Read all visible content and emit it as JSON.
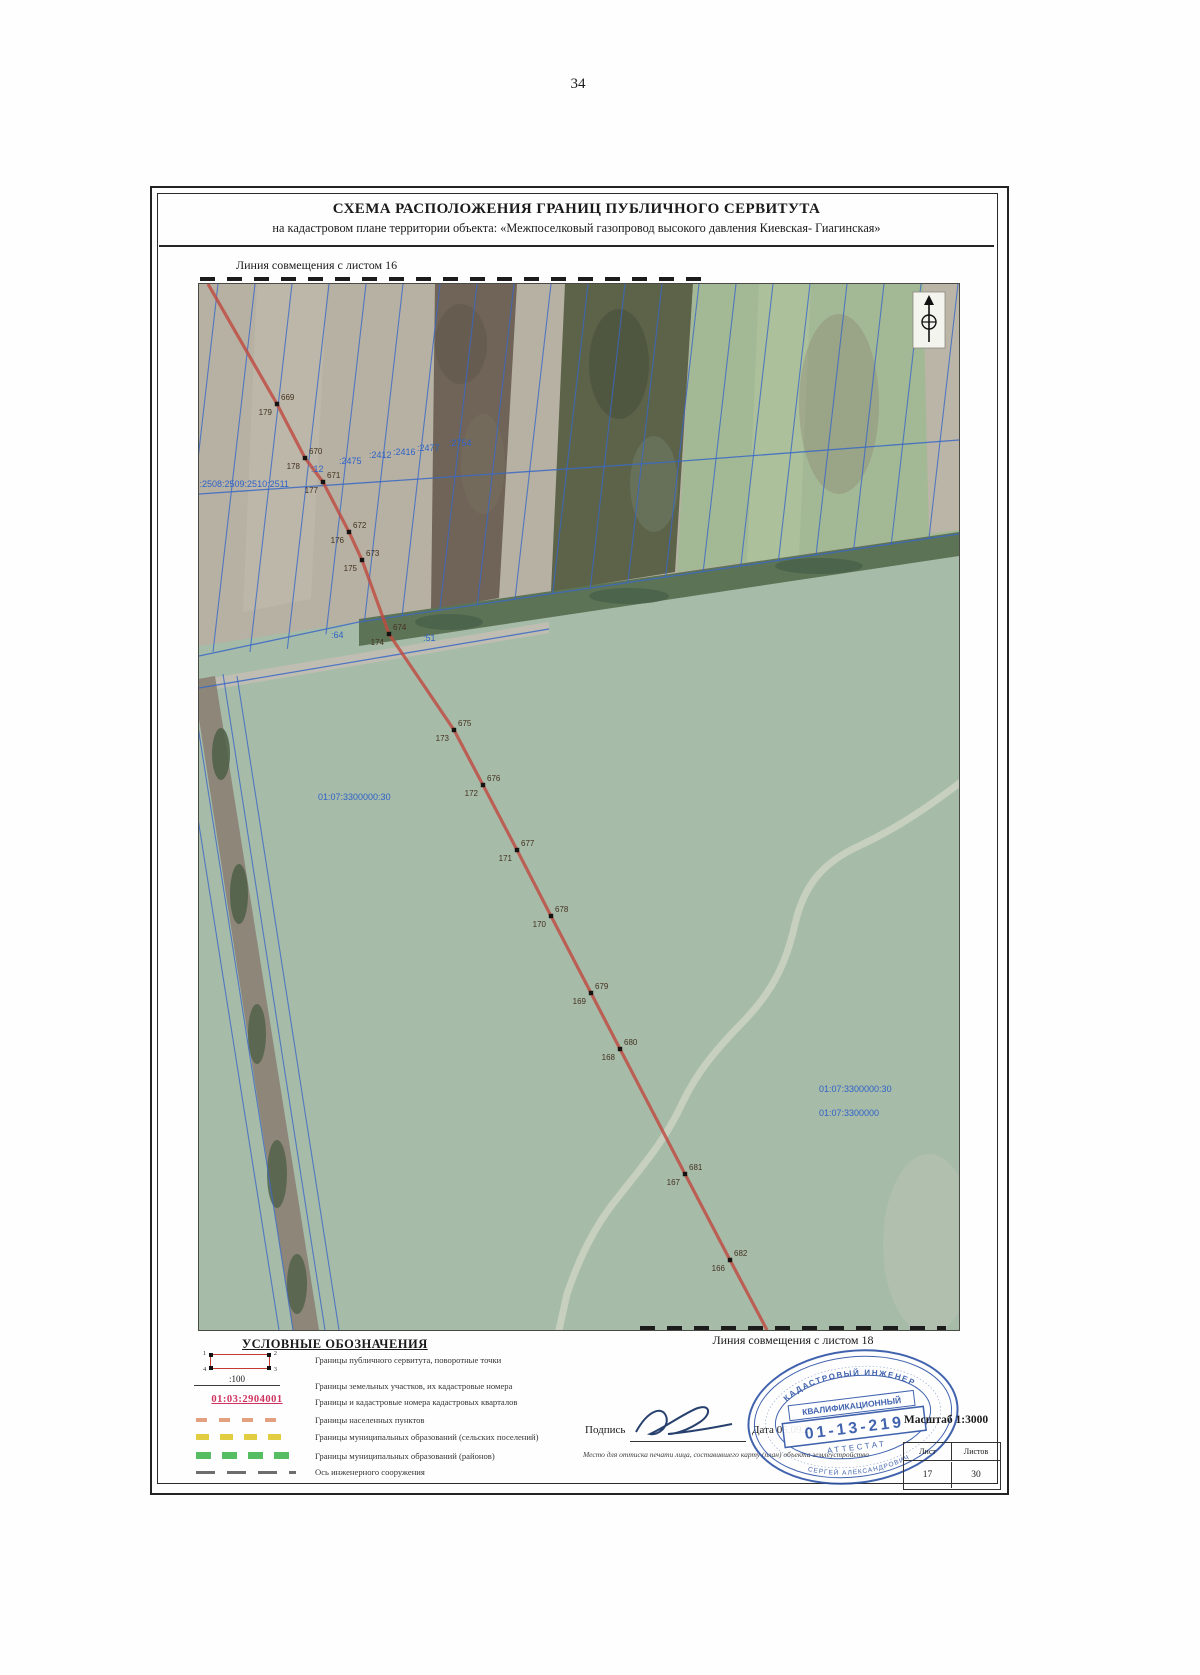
{
  "page": {
    "number": "34"
  },
  "header": {
    "title": "СХЕМА РАСПОЛОЖЕНИЯ ГРАНИЦ ПУБЛИЧНОГО СЕРВИТУТА",
    "subtitle": "на кадастровом плане территории объекта: «Межпоселковый газопровод высокого давления Киевская- Гиагинская»"
  },
  "map": {
    "match_top": "Линия совмещения с листом 16",
    "match_bottom": "Линия совмещения с листом 18",
    "line_start": {
      "x": 9,
      "y": 0
    },
    "line_end": {
      "x": 568,
      "y": 1046
    },
    "points": [
      {
        "id": "669",
        "num": "179",
        "x": 78,
        "y": 120
      },
      {
        "id": "670",
        "num": "178",
        "x": 106,
        "y": 174
      },
      {
        "id": "671",
        "num": "177",
        "x": 124,
        "y": 198
      },
      {
        "id": "672",
        "num": "176",
        "x": 150,
        "y": 248
      },
      {
        "id": "673",
        "num": "175",
        "x": 163,
        "y": 276
      },
      {
        "id": "674",
        "num": "174",
        "x": 190,
        "y": 350
      },
      {
        "id": "675",
        "num": "173",
        "x": 255,
        "y": 446
      },
      {
        "id": "676",
        "num": "172",
        "x": 284,
        "y": 501
      },
      {
        "id": "677",
        "num": "171",
        "x": 318,
        "y": 566
      },
      {
        "id": "678",
        "num": "170",
        "x": 352,
        "y": 632
      },
      {
        "id": "679",
        "num": "169",
        "x": 392,
        "y": 709
      },
      {
        "id": "680",
        "num": "168",
        "x": 421,
        "y": 765
      },
      {
        "id": "681",
        "num": "167",
        "x": 486,
        "y": 890
      },
      {
        "id": "682",
        "num": "166",
        "x": 531,
        "y": 976
      }
    ],
    "cadastral_labels": [
      {
        "text": ":51:2508:2509:2510:2511",
        "x": -12,
        "y": 203,
        "size": 8.5
      },
      {
        "text": ":12",
        "x": 112,
        "y": 188,
        "size": 8.5
      },
      {
        "text": ":2475",
        "x": 140,
        "y": 180
      },
      {
        "text": ":2412",
        "x": 170,
        "y": 174
      },
      {
        "text": ":2416",
        "x": 194,
        "y": 171
      },
      {
        "text": ":2477",
        "x": 218,
        "y": 167
      },
      {
        "text": ":2754",
        "x": 250,
        "y": 162,
        "size": 11
      },
      {
        "text": ":64",
        "x": 132,
        "y": 354
      },
      {
        "text": ":51",
        "x": 224,
        "y": 357
      },
      {
        "text": "01:07:3300000:30",
        "x": 119,
        "y": 516
      },
      {
        "text": "01:07:3300000:30",
        "x": 620,
        "y": 808
      },
      {
        "text": "01:07:3300000",
        "x": 620,
        "y": 832,
        "color": "#c455b2",
        "size": 9.5
      }
    ]
  },
  "legend": {
    "heading": "УСЛОВНЫЕ ОБОЗНАЧЕНИЯ",
    "corner_numbers": {
      "tl": "1",
      "tr": "2",
      "bl": "4",
      "br": "3"
    },
    "parcel_symbol_text": ":100",
    "quarter_symbol_text": "01:03:2904001",
    "items": [
      {
        "label": "Границы публичного сервитута, поворотные точки"
      },
      {
        "label": "Границы земельных участков, их кадастровые номера"
      },
      {
        "label": "Границы и кадастровые номера кадастровых кварталов"
      },
      {
        "label": "Границы населенных пунктов"
      },
      {
        "label": "Границы муниципальных образований (сельских поселений)"
      },
      {
        "label": "Границы муниципальных образований (районов)"
      },
      {
        "label": "Ось инженерного сооружения"
      }
    ]
  },
  "footer": {
    "signature_label": "Подпись",
    "date_label": "Дата",
    "date_value": "05.09.2",
    "note": "Место для оттиска печати лица, составившего карту (план) объекта землеустройства",
    "scale": "Масштаб 1:3000",
    "sheet_label": "Лист",
    "sheets_label": "Листов",
    "sheet_value": "17",
    "sheets_value": "30",
    "stamp": {
      "ring_top": "КАДАСТРОВЫЙ ИНЖЕНЕР",
      "ring_bottom": "СЕРГЕЙ АЛЕКСАНДРОВИЧ",
      "band": "КВАЛИФИКАЦИОННЫЙ",
      "number": "01-13-219",
      "attestat": "АТТЕСТАТ"
    }
  }
}
